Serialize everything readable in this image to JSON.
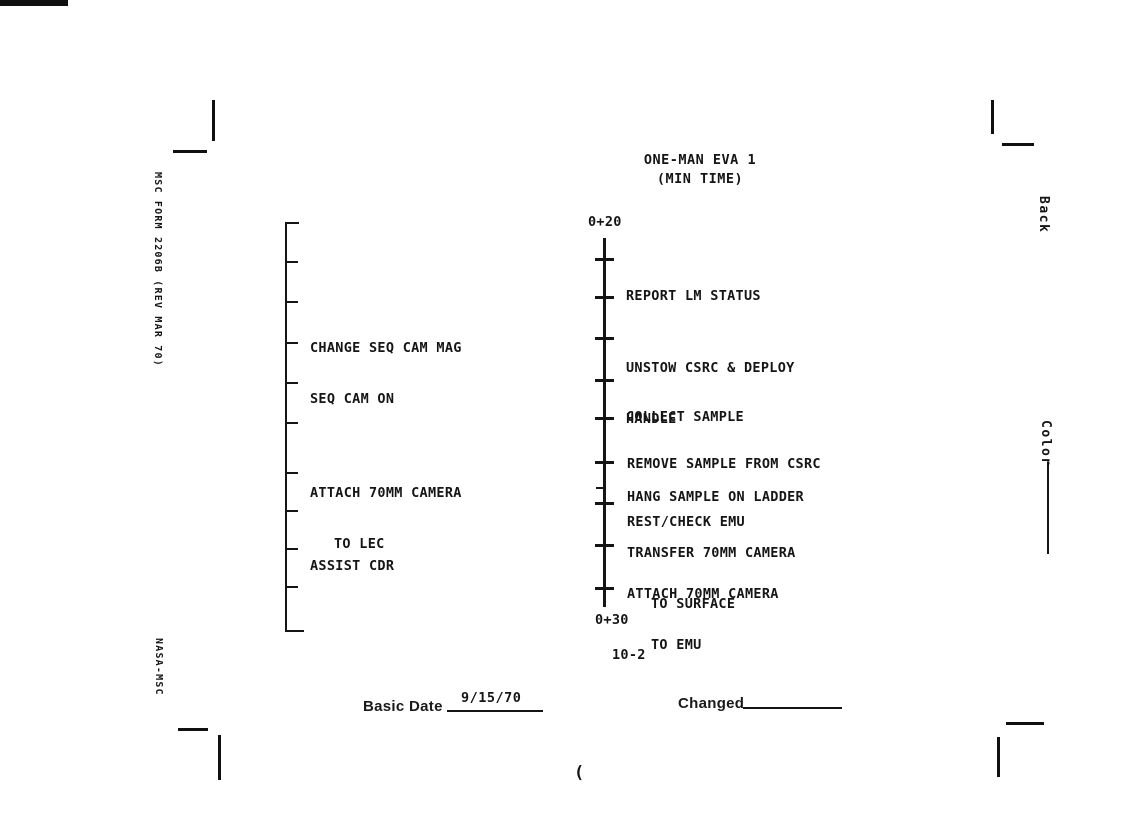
{
  "header": {
    "title": "ONE-MAN EVA 1",
    "subtitle": "(MIN TIME)"
  },
  "form": {
    "left_edge_label": "MSC FORM 2206B (REV MAR 70)",
    "left_edge_label2": "NASA-MSC",
    "right_edge_label_top": "Back",
    "right_edge_label_bottom": "Color"
  },
  "timeline": {
    "start_label": "0+20",
    "end_label": "0+30",
    "center_tasks": [
      {
        "lines": [
          "REPORT LM STATUS"
        ]
      },
      {
        "lines": [
          "UNSTOW CSRC & DEPLOY",
          "HANDLE"
        ]
      },
      {
        "lines": [
          "COLLECT SAMPLE"
        ]
      },
      {
        "lines": [
          "REMOVE SAMPLE FROM CSRC"
        ]
      },
      {
        "lines": [
          "HANG SAMPLE ON LADDER"
        ]
      },
      {
        "lines": [
          "REST/CHECK EMU"
        ]
      },
      {
        "lines": [
          "TRANSFER 70MM CAMERA",
          "TO SURFACE"
        ]
      },
      {
        "lines": [
          "ATTACH 70MM CAMERA",
          "TO EMU"
        ]
      }
    ],
    "left_tasks": [
      {
        "lines": [
          "CHANGE SEQ CAM MAG",
          "SEQ CAM ON"
        ]
      },
      {
        "lines": [
          "ATTACH 70MM CAMERA",
          "TO LEC"
        ]
      },
      {
        "lines": [
          "ASSIST CDR"
        ]
      }
    ]
  },
  "footer": {
    "basic_date_label": "Basic Date",
    "basic_date_value": "9/15/70",
    "changed_label": "Changed",
    "page_number": "10-2",
    "stray_mark": "("
  }
}
